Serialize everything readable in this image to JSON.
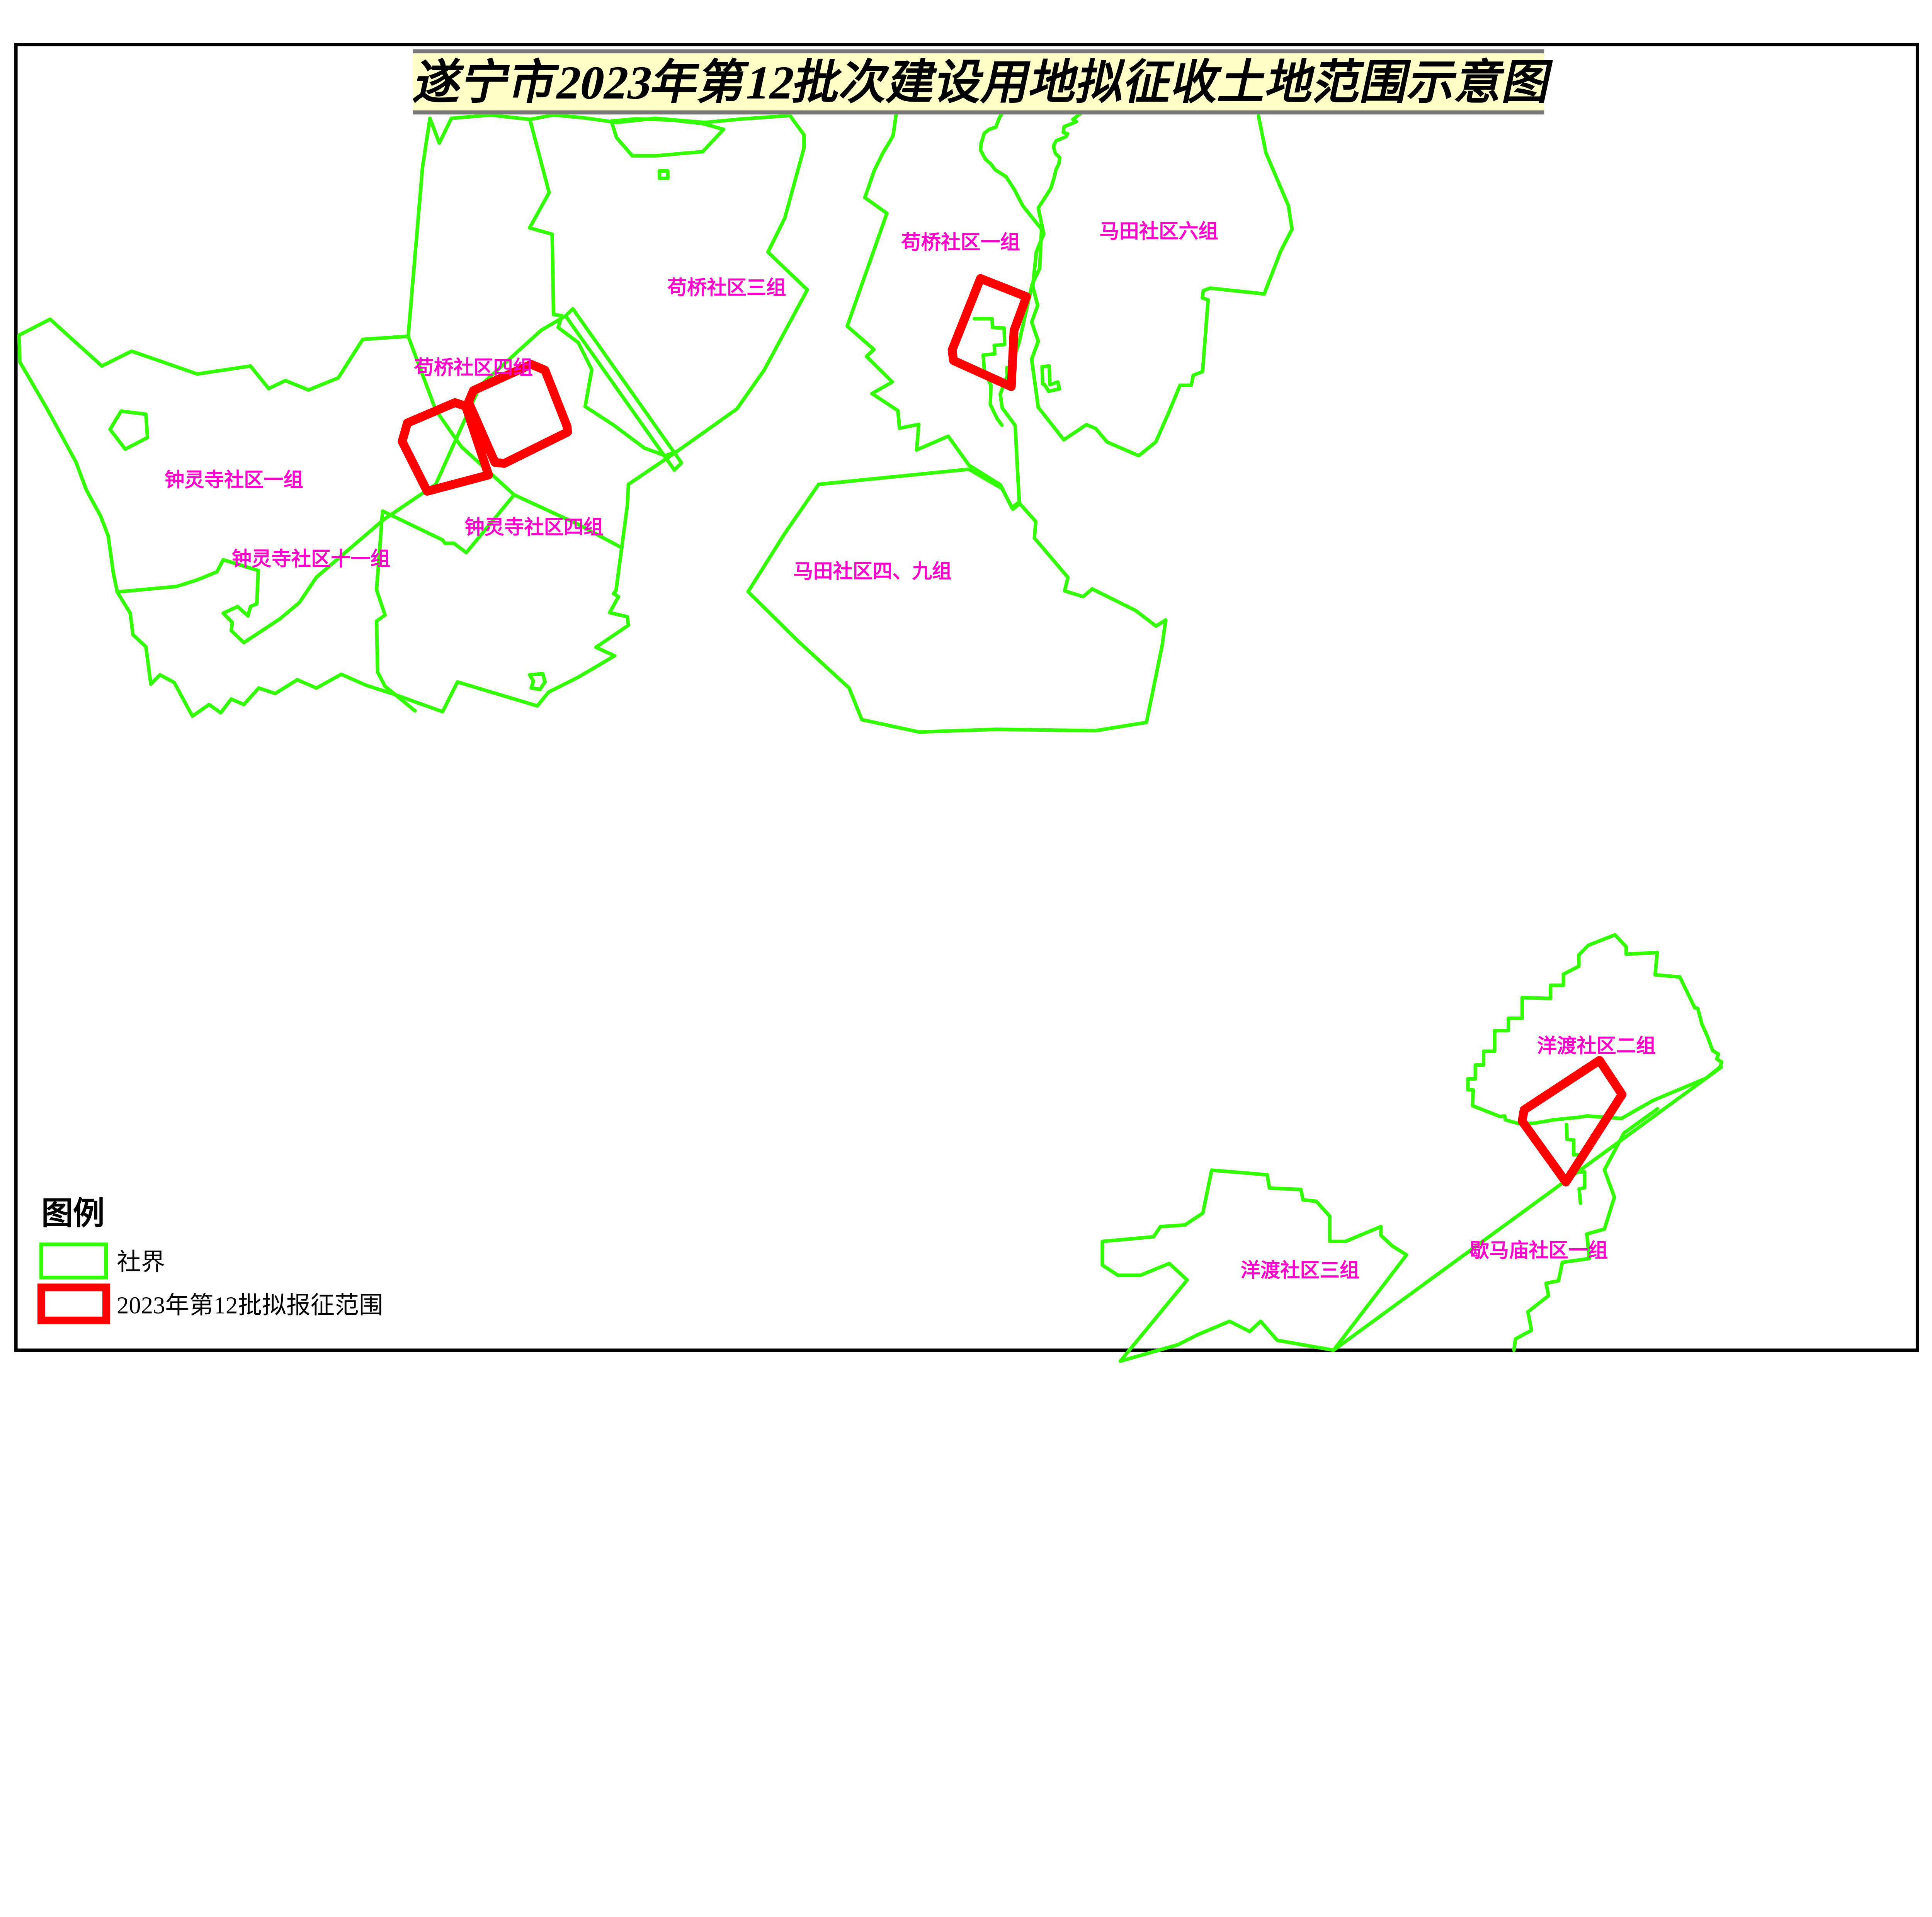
{
  "title": "遂宁市2023年第12批次建设用地拟征收土地范围示意图",
  "legend": {
    "header": "图例",
    "boundary_label": "社界",
    "acquisition_label": "2023年第12批拟报征范围"
  },
  "region_labels": [
    {
      "id": "gouqiao-4",
      "text": "苟桥社区四组"
    },
    {
      "id": "gouqiao-3",
      "text": "苟桥社区三组"
    },
    {
      "id": "gouqiao-1",
      "text": "苟桥社区一组"
    },
    {
      "id": "matian-6",
      "text": "马田社区六组"
    },
    {
      "id": "zhonglingsi-1",
      "text": "钟灵寺社区一组"
    },
    {
      "id": "zhonglingsi-4",
      "text": "钟灵寺社区四组"
    },
    {
      "id": "zhonglingsi-11",
      "text": "钟灵寺社区十一组"
    },
    {
      "id": "matian-4-9",
      "text": "马田社区四、九组"
    },
    {
      "id": "yangdu-2",
      "text": "洋渡社区二组"
    },
    {
      "id": "yangdu-3",
      "text": "洋渡社区三组"
    },
    {
      "id": "xiemamiao-1",
      "text": "歇马庙社区一组"
    }
  ],
  "colors": {
    "boundary": "#33ff00",
    "acquisition": "#ff0000",
    "label": "#ff00cc",
    "title_bg": "#ffffc8",
    "title_bar": "#787878",
    "frame": "#000000"
  }
}
